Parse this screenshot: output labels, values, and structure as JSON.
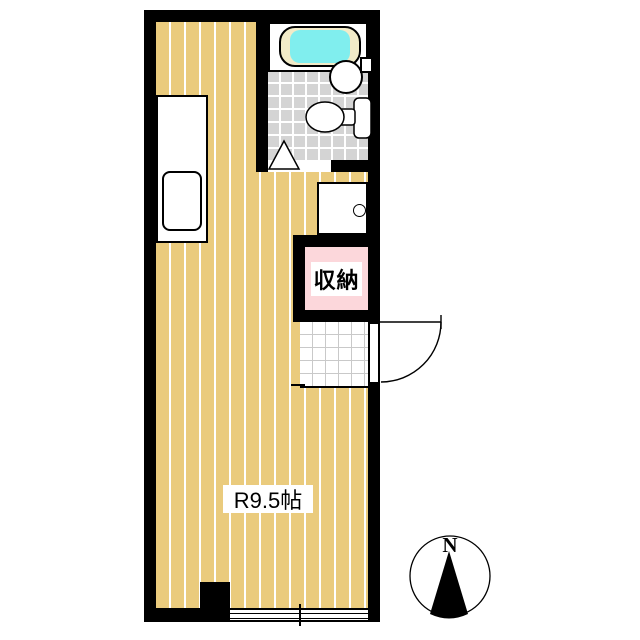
{
  "floor_plan": {
    "room": {
      "label": "R9.5帖"
    },
    "closet": {
      "label": "収納"
    },
    "compass": {
      "label": "N"
    },
    "colors": {
      "wall": "#000000",
      "flooring": "#EACB7D",
      "floor_stripe": "#FFFFFF",
      "bath_tile": "#D4D4D4",
      "tile_grout": "#FFFFFF",
      "bathtub_water": "#80EEEE",
      "bathtub_rim": "#F2EBC8",
      "closet_fill": "#FCD7DB",
      "entry_grid_line": "#C9C9C9",
      "background": "#FFFFFF"
    },
    "fixtures": [
      "kitchen-counter",
      "kitchen-sink",
      "bathtub",
      "wash-basin",
      "faucet",
      "toilet",
      "bathroom-door-triangle",
      "vanity-unit",
      "storage-closet",
      "entryway-tile",
      "entry-door",
      "sliding-window",
      "pillar",
      "compass-north"
    ]
  }
}
